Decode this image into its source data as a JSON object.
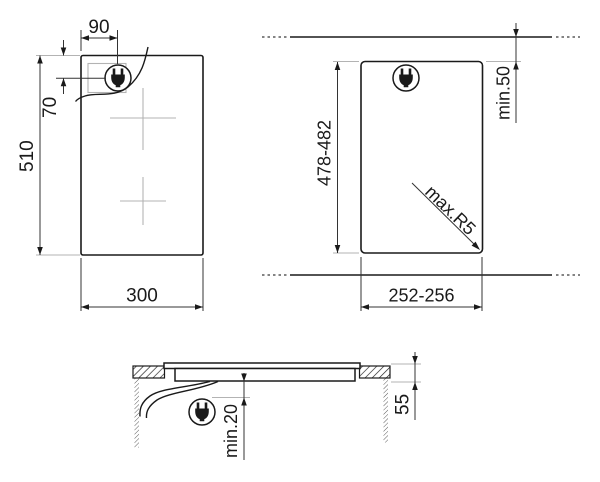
{
  "plan_view": {
    "hob_width": "300",
    "hob_depth": "510",
    "plug_offset_from_left": "90",
    "plug_offset_from_top": "70"
  },
  "cutout_view": {
    "cutout_length": "478-482",
    "cutout_width": "252-256",
    "min_rear_clearance": "min.50",
    "max_corner_radius": "max.R5"
  },
  "section_view": {
    "hob_height": "55",
    "min_bottom_clearance": "min.20"
  },
  "icons": {
    "power_plug": "power-plug-icon"
  },
  "colors": {
    "line": "#1a1a1a",
    "auxiliary_line": "#b3b3b3",
    "background": "#ffffff"
  }
}
